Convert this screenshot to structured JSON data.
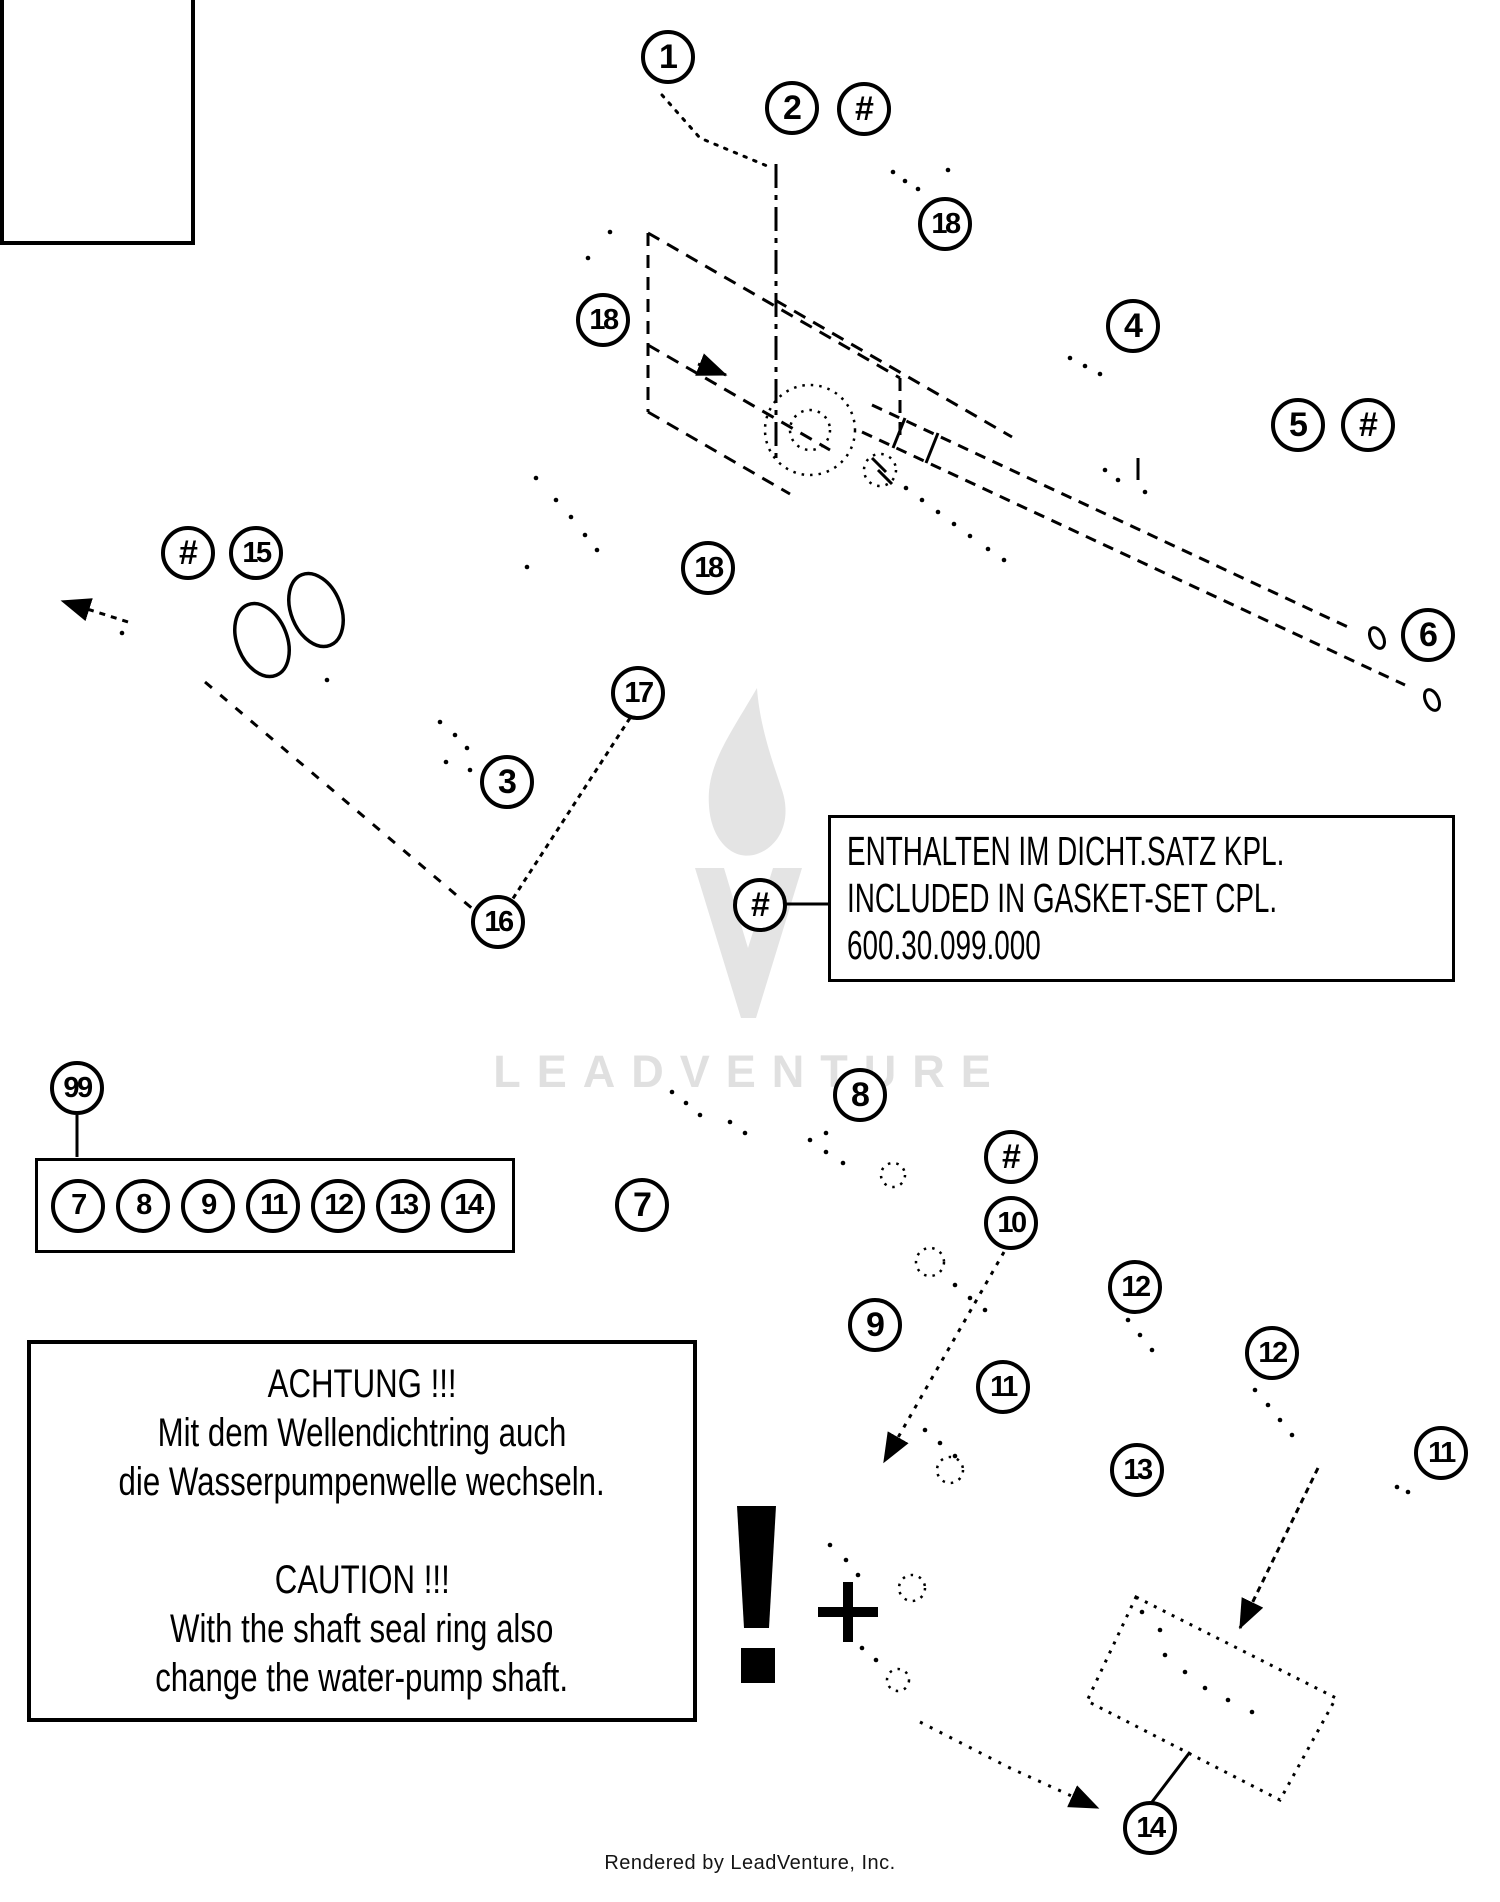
{
  "page": {
    "watermark_text": "LEADVENTURE",
    "footer_text": "Rendered by LeadVenture, Inc."
  },
  "note_box": {
    "lines": [
      "ENTHALTEN IM DICHT.SATZ KPL.",
      "INCLUDED IN GASKET-SET CPL.",
      "600.30.099.000"
    ],
    "leader_label": "#"
  },
  "warning_box": {
    "lines": [
      "ACHTUNG !!!",
      "Mit dem Wellendichtring auch",
      "die Wasserpumpenwelle wechseln.",
      "",
      "CAUTION !!!",
      "With the shaft seal ring also",
      "change the water-pump shaft."
    ]
  },
  "legend": {
    "lead_label": "99",
    "items": [
      "7",
      "8",
      "9",
      "11",
      "12",
      "13",
      "14"
    ]
  },
  "symbols": {
    "exclamation": "!",
    "plus": "+"
  },
  "colors": {
    "line": "#000000",
    "watermark": "#e0e0e0",
    "background": "#ffffff"
  },
  "callouts": [
    {
      "label": "1",
      "x": 668,
      "y": 57
    },
    {
      "label": "2",
      "x": 792,
      "y": 108
    },
    {
      "label": "#",
      "x": 864,
      "y": 109
    },
    {
      "label": "18",
      "x": 945,
      "y": 224
    },
    {
      "label": "18",
      "x": 603,
      "y": 320
    },
    {
      "label": "4",
      "x": 1133,
      "y": 326
    },
    {
      "label": "5",
      "x": 1298,
      "y": 425
    },
    {
      "label": "#",
      "x": 1368,
      "y": 425
    },
    {
      "label": "#",
      "x": 188,
      "y": 553
    },
    {
      "label": "15",
      "x": 256,
      "y": 553
    },
    {
      "label": "18",
      "x": 708,
      "y": 568
    },
    {
      "label": "6",
      "x": 1428,
      "y": 635
    },
    {
      "label": "17",
      "x": 638,
      "y": 693
    },
    {
      "label": "3",
      "x": 507,
      "y": 782
    },
    {
      "label": "16",
      "x": 498,
      "y": 922
    },
    {
      "label": "#",
      "x": 760,
      "y": 905
    },
    {
      "label": "99",
      "x": 77,
      "y": 1088
    },
    {
      "label": "8",
      "x": 860,
      "y": 1095
    },
    {
      "label": "#",
      "x": 1011,
      "y": 1157
    },
    {
      "label": "7",
      "x": 642,
      "y": 1205
    },
    {
      "label": "10",
      "x": 1011,
      "y": 1223
    },
    {
      "label": "9",
      "x": 875,
      "y": 1325
    },
    {
      "label": "12",
      "x": 1135,
      "y": 1287
    },
    {
      "label": "12",
      "x": 1272,
      "y": 1353
    },
    {
      "label": "11",
      "x": 1003,
      "y": 1387
    },
    {
      "label": "11",
      "x": 1441,
      "y": 1453
    },
    {
      "label": "13",
      "x": 1137,
      "y": 1470
    },
    {
      "label": "14",
      "x": 1150,
      "y": 1828
    }
  ]
}
